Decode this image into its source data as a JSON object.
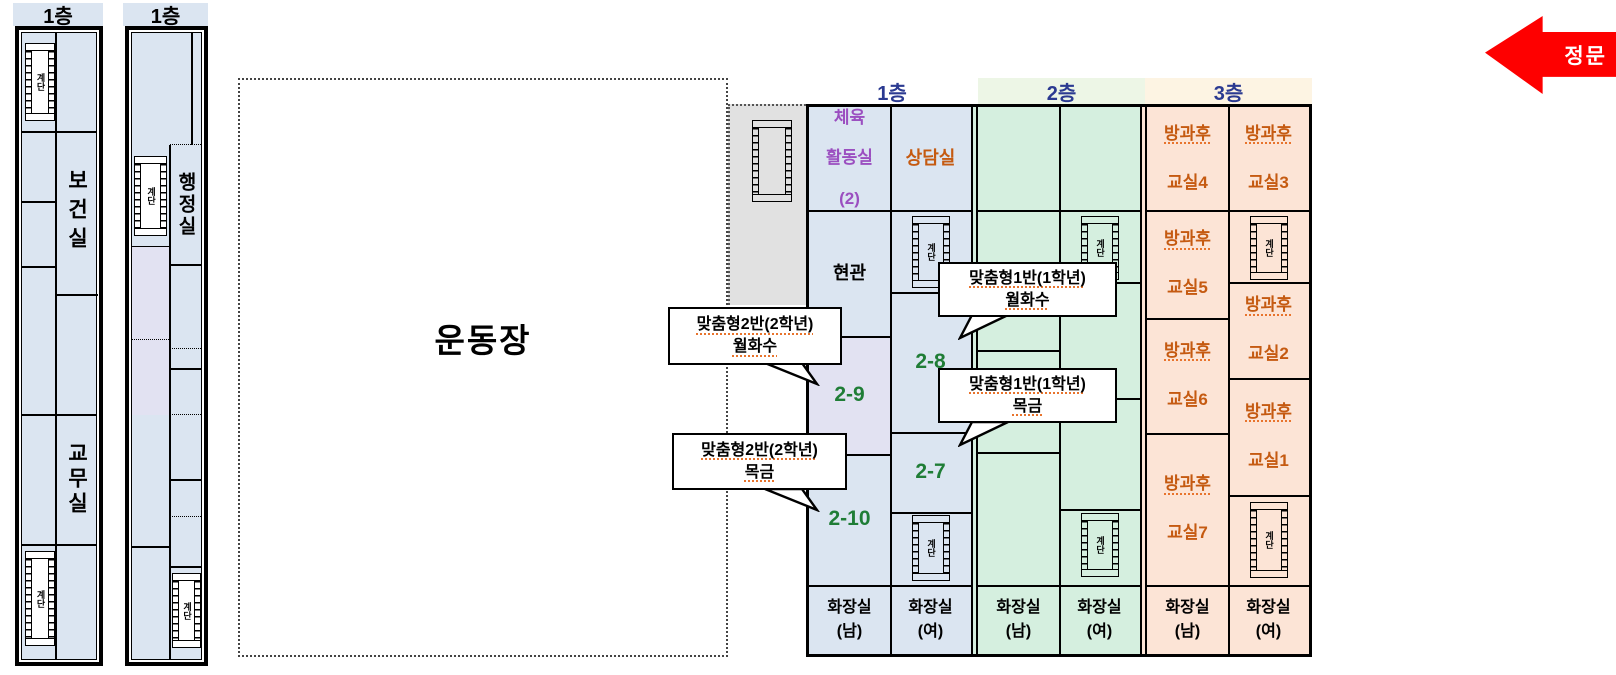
{
  "colors": {
    "floor1_fill": "#dbe5f1",
    "floor2_fill": "#d5efdf",
    "floor3_fill": "#fce4d6",
    "lavender_fill": "#e2e2f2",
    "gray_yard_fill": "#e1e1e1",
    "header2_strip": "#edf6e6",
    "header3_strip": "#fdf4e3",
    "floor_header_text": "#2b3a91",
    "gym_text": "#9b4fc0",
    "room_brown_text": "#c55a11",
    "room_number_green": "#1f7d36",
    "gate_red": "#fe0000"
  },
  "gate": {
    "label": "정문"
  },
  "playground": {
    "label": "운동장"
  },
  "stairs": {
    "label": "계단"
  },
  "left_building_a": {
    "header": "1층",
    "room_upper": "보건실",
    "room_lower": "교무실"
  },
  "left_building_b": {
    "header": "1층",
    "room": "행정실"
  },
  "main_building": {
    "floor1": {
      "header": "1층",
      "gym_l1": "체육",
      "gym_l2": "활동실",
      "gym_l3": "(2)",
      "counsel": "상담실",
      "entrance": "현관",
      "room_2_8": "2-8",
      "room_2_9": "2-9",
      "room_2_7": "2-7",
      "room_2_10": "2-10",
      "toilet_m": "화장실\n(남)",
      "toilet_f": "화장실\n(여)"
    },
    "floor2": {
      "header": "2층",
      "toilet_m": "화장실\n(남)",
      "toilet_f": "화장실\n(여)"
    },
    "floor3": {
      "header": "3층",
      "after4_l1": "방과후",
      "after4_l2": "교실4",
      "after3_l1": "방과후",
      "after3_l2": "교실3",
      "after5_l1": "방과후",
      "after5_l2": "교실5",
      "after2_l1": "방과후",
      "after2_l2": "교실2",
      "after6_l1": "방과후",
      "after6_l2": "교실6",
      "after1_l1": "방과후",
      "after1_l2": "교실1",
      "after7_l1": "방과후",
      "after7_l2": "교실7",
      "toilet_m": "화장실\n(남)",
      "toilet_f": "화장실\n(여)"
    }
  },
  "callouts": {
    "c1": {
      "line1": "맞춤형2반(2학년)",
      "line2": "월화수"
    },
    "c2": {
      "line1": "맞춤형1반(1학년)",
      "line2": "월화수"
    },
    "c3": {
      "line1": "맞춤형1반(1학년)",
      "line2": "목금"
    },
    "c4": {
      "line1": "맞춤형2반(2학년)",
      "line2": "목금"
    }
  }
}
